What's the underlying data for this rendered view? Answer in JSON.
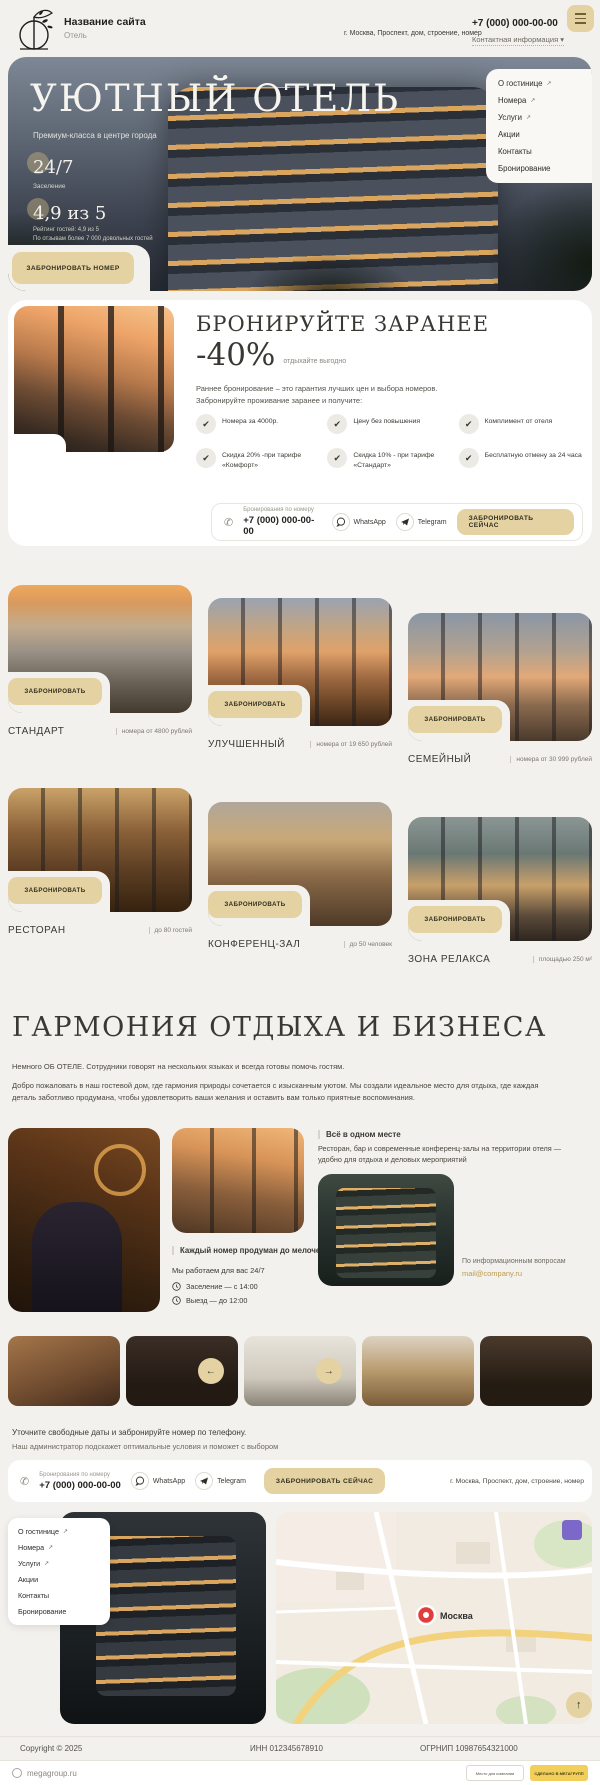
{
  "theme": {
    "accent": "#e4d2a2",
    "page_bg": "#f3f1ed",
    "email_link": "#bd9a4e",
    "map_pin": "#e23d3d"
  },
  "icons": {
    "check": "✔",
    "phone": "✆",
    "up": "↑",
    "prev": "←",
    "next": "→",
    "chevron": "▾"
  },
  "header": {
    "site_name": "Название сайта",
    "site_type": "Отель",
    "address": "г. Москва, Проспект, дом, строение, номер",
    "phone": "+7 (000) 000-00-00",
    "contact_info": "Контактная информация"
  },
  "nav": {
    "items": [
      {
        "label": "О гостинице",
        "ext": "↗"
      },
      {
        "label": "Номера",
        "ext": "↗"
      },
      {
        "label": "Услуги",
        "ext": "↗"
      },
      {
        "label": "Акции"
      },
      {
        "label": "Контакты"
      },
      {
        "label": "Бронирование"
      }
    ]
  },
  "hero": {
    "title": "УЮТНЫЙ ОТЕЛЬ",
    "subtitle": "Премиум-класса в центре города",
    "stat_hours": "24/7",
    "stat_hours_label": "Заселение",
    "rating": "4,9 из 5",
    "rating_line1": "Рейтинг гостей: 4,9 из 5",
    "rating_line2": "По отзывам более 7 000 довольных гостей",
    "cta": "ЗАБРОНИРОВАТЬ НОМЕР"
  },
  "early": {
    "title": "БРОНИРУЙТЕ ЗАРАНЕЕ",
    "discount": "-40%",
    "discount_note": "отдыхайте выгодно",
    "lead1": "Раннее бронирование – это гарантия лучших цен и выбора номеров.",
    "lead2": "Забронируйте проживание заранее и получите:",
    "benefits": [
      "Номера за 4000р.",
      "Цену без повышения",
      "Комплимент от отеля",
      "Скидка 20% -при тарифе «Комфорт»",
      "Скидка 10% - при тарифе «Стандарт»",
      "Бесплатную отмену за 24 часа"
    ]
  },
  "contact_bar": {
    "phone_label": "Бронирования по номеру",
    "phone": "+7 (000) 000-00-00",
    "whatsapp": "WhatsApp",
    "telegram": "Telegram",
    "cta": "ЗАБРОНИРОВАТЬ СЕЙЧАС"
  },
  "rooms": {
    "cta": "ЗАБРОНИРОВАТЬ",
    "items": [
      {
        "name": "СТАНДАРТ",
        "info": "номера от 4800 рублей"
      },
      {
        "name": "УЛУЧШЕННЫЙ",
        "info": "номера от 19 650 рублей"
      },
      {
        "name": "СЕМЕЙНЫЙ",
        "info": "номера от 30 999 рублей"
      },
      {
        "name": "РЕСТОРАН",
        "info": "до 80 гостей"
      },
      {
        "name": "КОНФЕРЕНЦ-ЗАЛ",
        "info": "до 50 человек"
      },
      {
        "name": "ЗОНА РЕЛАКСА",
        "info": "площадью 250 м²"
      }
    ]
  },
  "about": {
    "title": "ГАРМОНИЯ ОТДЫХА И БИЗНЕСА",
    "p1": "Немного ОБ ОТЕЛЕ. Сотрудники говорят на нескольких языках и всегда готовы помочь гостям.",
    "p2": "Добро пожаловать в наш гостевой дом, где гармония природы сочетается с изысканным уютом. Мы создали идеальное место для отдыха, где каждая деталь заботливо продумана, чтобы удовлетворить ваши желания и оставить вам только приятные воспоминания.",
    "room_caption": "Каждый номер продуман до мелочей",
    "hours": "Мы работаем для вас 24/7",
    "checkin": "Заселение — с 14:00",
    "checkout": "Выезд — до 12:00",
    "one_place_title": "Всё в одном месте",
    "one_place_text": "Ресторан, бар и современные конференц-залы на территории отеля — удобно для отдыха и деловых мероприятий",
    "info_label": "По информационным вопросам",
    "email": "mail@company.ru"
  },
  "cta_section": {
    "line1": "Уточните свободные даты и забронируйте номер по телефону.",
    "line2": "Наш администратор подскажет оптимальные условия и поможет с выбором",
    "address": "г. Москва, Проспект, дом, строение, номер"
  },
  "map": {
    "city": "Москва"
  },
  "footer": {
    "copyright": "Copyright © 2025",
    "inn": "ИНН 012345678910",
    "ogrnip": "ОГРНИП 10987654321000",
    "megagroup": "megagroup.ru",
    "badge1": "Место для компании",
    "badge2": "СДЕЛАНО В МЕГАГРУПП"
  }
}
